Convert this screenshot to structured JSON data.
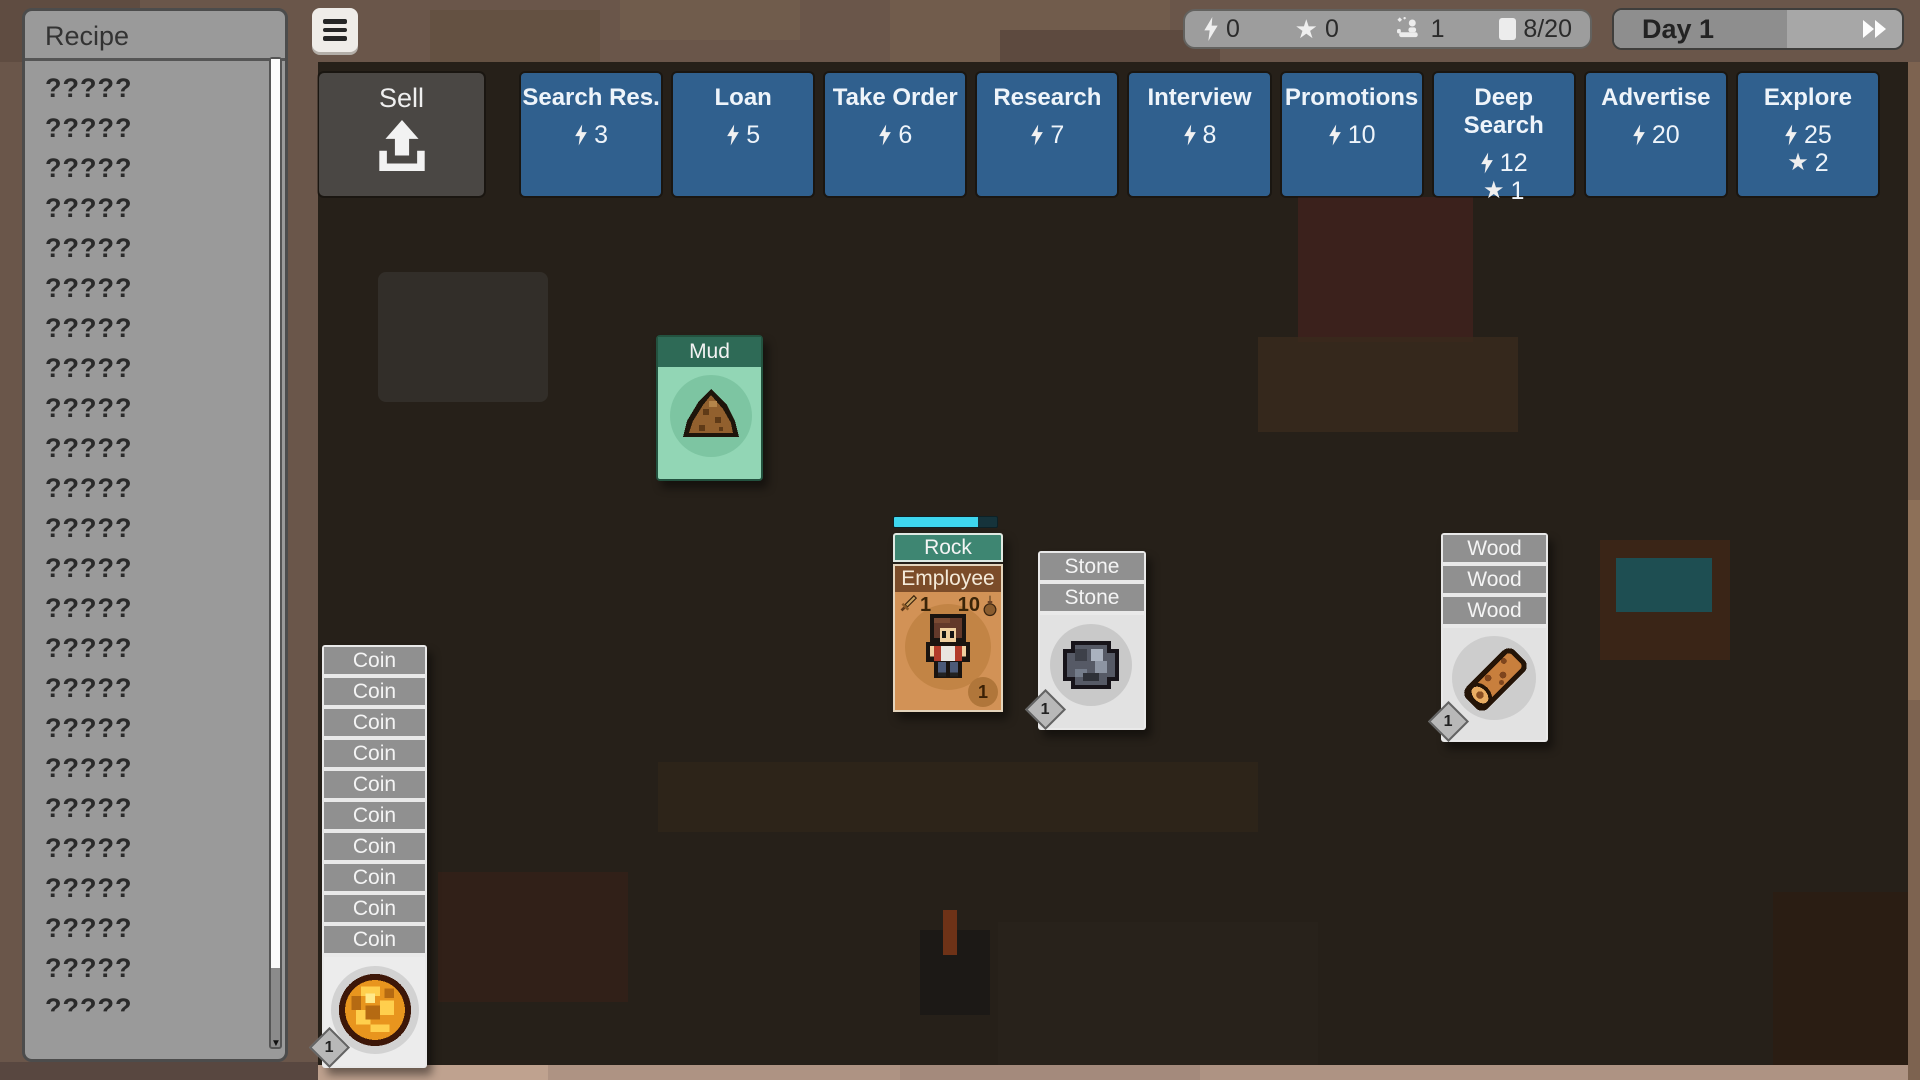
{
  "recipe_panel": {
    "title": "Recipe",
    "items": [
      "?????",
      "?????",
      "?????",
      "?????",
      "?????",
      "?????",
      "?????",
      "?????",
      "?????",
      "?????",
      "?????",
      "?????",
      "?????",
      "?????",
      "?????",
      "?????",
      "?????",
      "?????",
      "?????",
      "?????",
      "?????",
      "?????",
      "?????",
      "?????",
      "?????"
    ]
  },
  "status_bar": {
    "energy": "0",
    "stars": "0",
    "staff": "1",
    "cards": "8/20"
  },
  "day_bar": {
    "label": "Day 1",
    "progress_percent": 60
  },
  "sell_button": {
    "label": "Sell"
  },
  "action_buttons": [
    {
      "label": "Search Res.",
      "energy": "3"
    },
    {
      "label": "Loan",
      "energy": "5"
    },
    {
      "label": "Take Order",
      "energy": "6"
    },
    {
      "label": "Research",
      "energy": "7"
    },
    {
      "label": "Interview",
      "energy": "8"
    },
    {
      "label": "Promotions",
      "energy": "10"
    },
    {
      "label": "Deep Search",
      "energy": "12",
      "stars": "1"
    },
    {
      "label": "Advertise",
      "energy": "20"
    },
    {
      "label": "Explore",
      "energy": "25",
      "stars": "2"
    }
  ],
  "board": {
    "mud_card": {
      "title": "Mud"
    },
    "rock_stack": {
      "header": "Rock",
      "progress_percent": 82,
      "employee": {
        "title": "Employee",
        "attack": "1",
        "carry": "10",
        "level": "1"
      }
    },
    "stone_stack": {
      "headers": [
        "Stone",
        "Stone"
      ],
      "value": "1"
    },
    "wood_stack": {
      "headers": [
        "Wood",
        "Wood",
        "Wood"
      ],
      "value": "1"
    },
    "coin_stack": {
      "headers": [
        "Coin",
        "Coin",
        "Coin",
        "Coin",
        "Coin",
        "Coin",
        "Coin",
        "Coin",
        "Coin",
        "Coin"
      ],
      "value": "1"
    }
  },
  "colors": {
    "board_dark": "#262019",
    "wood_frame": "#6a564a",
    "action_blue": "#30608e",
    "sell_gray": "#4a4744",
    "panel_gray": "#9a9a9a",
    "teal_card_header": "#3e8672",
    "mud_body_green": "#92d6b5",
    "mud_header_green": "#2e6a56",
    "employee_body": "#d29256",
    "employee_header": "#7b4c29",
    "gray_card_header": "#909090",
    "card_white": "#e9e9e9",
    "progress_cyan": "#3ed6ee",
    "coin_gold": "#e8951e"
  }
}
